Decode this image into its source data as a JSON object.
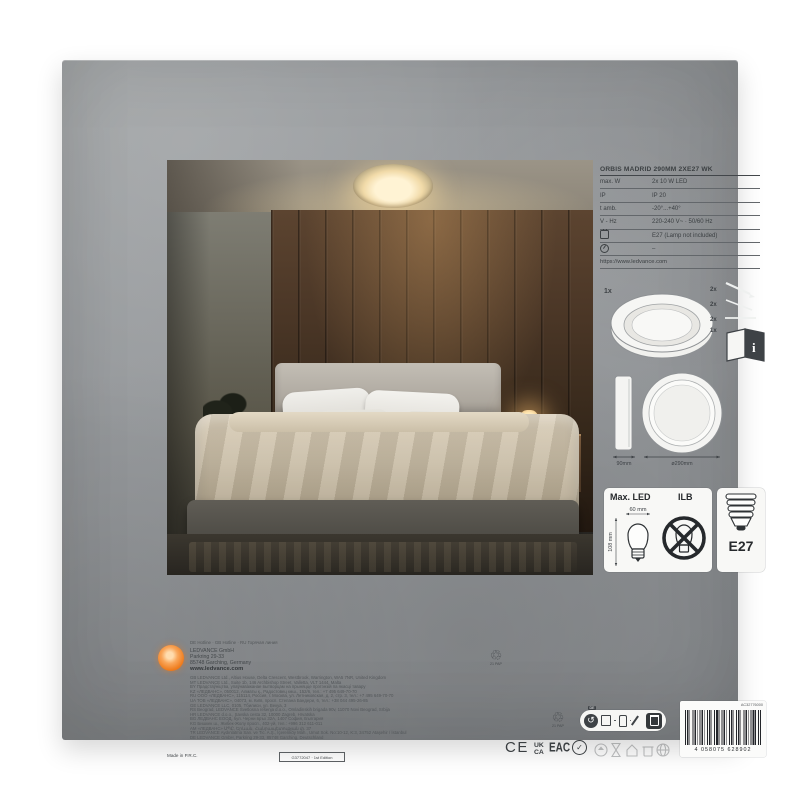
{
  "spec": {
    "title": "ORBIS MADRID 290MM 2XE27 WK",
    "rows": [
      {
        "label": "max. W",
        "value": "2x 10 W LED"
      },
      {
        "label": "IP",
        "value": "IP 20"
      },
      {
        "label": "t amb.",
        "value": "-20°...+40°"
      },
      {
        "label": "V - Hz",
        "value": "220-240 V~ · 50/60 Hz"
      },
      {
        "label": "",
        "value": "E27 (Lamp not included)"
      },
      {
        "label": "",
        "value": "–"
      }
    ],
    "url": "https://www.ledvance.com"
  },
  "contents": {
    "luminaire_qty": "1x",
    "screws_qty": "2x",
    "plugs_qty": "2x",
    "rods_qty": "2x",
    "manual_qty": "1x"
  },
  "dims": {
    "side": "90mm",
    "diameter": "ø290mm"
  },
  "lamp_box": {
    "max_led": "Max. LED",
    "ilb": "ILB",
    "bulb_width": "60 mm",
    "bulb_height": "108 mm",
    "base": "E27"
  },
  "maker": {
    "hotlines": "DE Hotline · GB Hotline · RU Горячая линия",
    "company": "LEDVANCE GmbH",
    "street": "Parkring 29-33",
    "city": "85748 Garching, Germany",
    "web": "www.ledvance.com",
    "distributors": [
      "GB LEDVANCE Ltd., Altius House, Delta Crescent, Westbrook, Warrington, WA5 7NR, United Kingdom",
      "MT LEDVANCE Ltd., Suite 1b, 146 Archbishop Street, Valletta, VLT 1444, Malta",
      "BY Прадстаўніцтва, упаўнаважанае вытворцам на прыняцце прэтэнзій па якасці тавару",
      "KZ «ЛЕДВАНС», 050012, Алматы қ., Радостовец көш., 152/6, тел.: +7 495 649-70-70",
      "RU ООО «ЛЕДВАНС», 115114, Россия, г. Москва, ул. Летниковская, д. 2, стр. 3, тел.: +7 495 649-70-70",
      "UA ТОВ «ЛЕДВАНС», 04073, м. Київ, просп. Степана Бандери, 6, тел.: +38 044 495-26-85",
      "GE LEDVANCE LLC, 0105, Тбилиси, ул. Векуа, 3",
      "RS Beograd, LEDVANCE Svetlosna rešenja d.o.o., Omladinskih brigada 90v, 11070 Novi Beograd, Srbija",
      "HR LEDVANCE d.o.o., Savska cesta 32, 10000 Zagreb, Hrvatska",
      "BG ЛЕДВАНС ЕООД, бул. Черни връх 32А, 1407 София, България",
      "KG Бишкек ш., Жибек-Жолу просп., 402-үй, тел.: +996 312 611-011",
      "AM «ЛЕДВАНС» ՍՊԸ, Երևան, Հանրապետության փ. 37",
      "TR LEDVANCE Aydınlatma San. ve Tic. A.Ş., İçerenköy Mah., Umut Sok. No:10-12, K:3, 34752 Ataşehir / İstanbul",
      "DE LEDVANCE GmbH, Parkring 29-33, 85748 Garching, Deutschland"
    ]
  },
  "footer": {
    "made_in": "Made in P.R.C.",
    "edition": "G3772047 · 1st Edition",
    "pap_code": "21 PAP",
    "disposal_country": "DE",
    "ce": "CE",
    "ukca_top": "UK",
    "ukca_bottom": "CA",
    "eac": "EAC",
    "barcode_number": "4 058075 628902",
    "barcode_code": "AC32776000"
  },
  "icons": {
    "recycle": "♲",
    "green_dot": "↺"
  },
  "colors": {
    "accent_orange": "#ed6c0e",
    "box_gray": "#94979a",
    "print_gray": "#3f4346",
    "photo_wood": "#42301f",
    "duvet_beige": "#c7bba4"
  }
}
